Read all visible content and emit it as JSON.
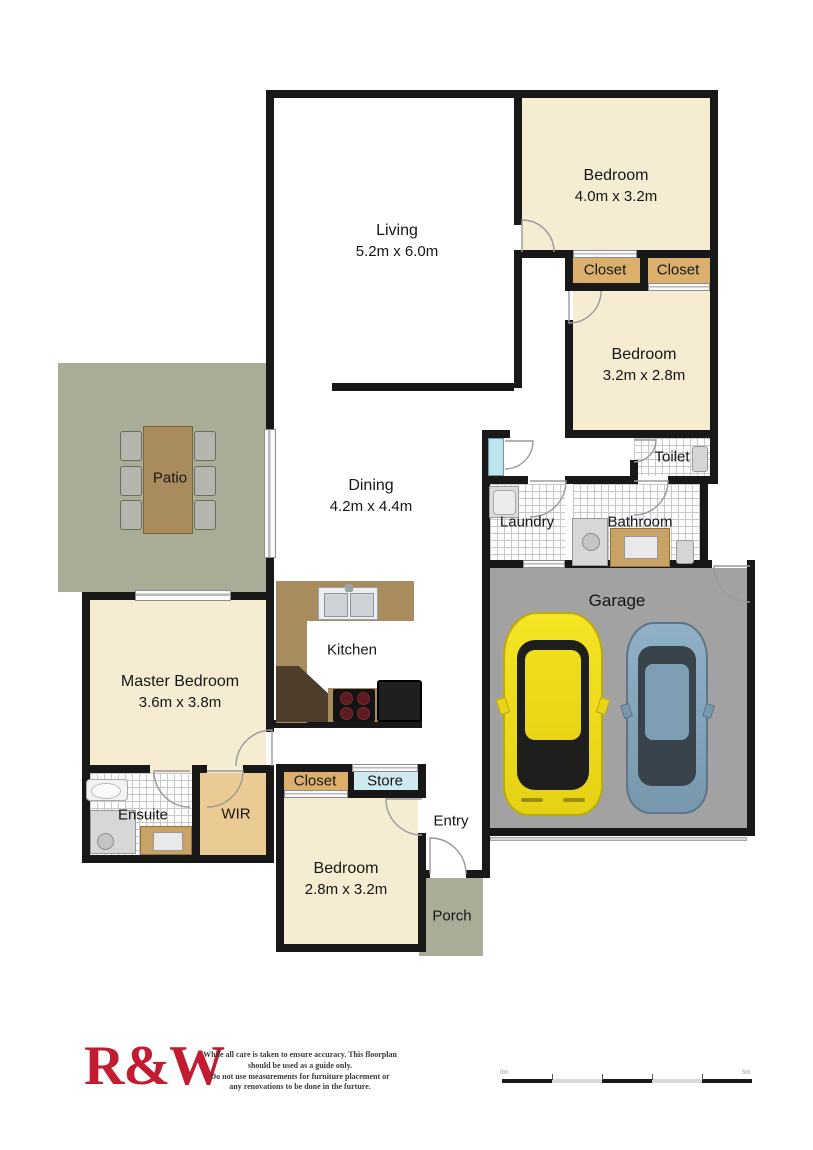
{
  "colors": {
    "wall": "#181818",
    "cream": "#f5ecd2",
    "closet_tan": "#dcb06c",
    "wir_tan": "#ebcb94",
    "store_blue": "#cfe9f1",
    "linen_blue": "#bee3ec",
    "outdoor_green": "#a9ad98",
    "garage_grey": "#a2a2a3",
    "wood": "#a98c5e",
    "dark_wood": "#4f3d2c",
    "car_yellow": "#f2e01e",
    "car_blue": "#87a7bf",
    "logo_red": "#c31b2f"
  },
  "rooms": {
    "living": {
      "name": "Living",
      "dims": "5.2m x 6.0m"
    },
    "bedroom_top": {
      "name": "Bedroom",
      "dims": "4.0m x 3.2m"
    },
    "bedroom_mid": {
      "name": "Bedroom",
      "dims": "3.2m x 2.8m"
    },
    "bedroom_bottom": {
      "name": "Bedroom",
      "dims": "2.8m x 3.2m"
    },
    "master_bedroom": {
      "name": "Master Bedroom",
      "dims": "3.6m x 3.8m"
    },
    "dining": {
      "name": "Dining",
      "dims": "4.2m x 4.4m"
    },
    "kitchen": {
      "name": "Kitchen"
    },
    "patio": {
      "name": "Patio"
    },
    "porch": {
      "name": "Porch"
    },
    "entry": {
      "name": "Entry"
    },
    "garage": {
      "name": "Garage"
    },
    "laundry": {
      "name": "Laundry"
    },
    "bathroom": {
      "name": "Bathroom"
    },
    "toilet": {
      "name": "Toilet"
    },
    "ensuite": {
      "name": "Ensuite"
    },
    "wir": {
      "name": "WIR"
    },
    "closet_top_left": {
      "name": "Closet"
    },
    "closet_top_right": {
      "name": "Closet"
    },
    "closet_bottom": {
      "name": "Closet"
    },
    "store": {
      "name": "Store"
    }
  },
  "footer": {
    "logo_text": "R&W",
    "disclaimer_lines": [
      "While all care is taken to ensure accuracy. This floorplan",
      "should be used as a guide only.",
      "Do not use measurements for furniture placement or",
      "any renovations to be done in the furture."
    ],
    "scale_bar": {
      "start_label": "0m",
      "end_label": "5m"
    }
  }
}
